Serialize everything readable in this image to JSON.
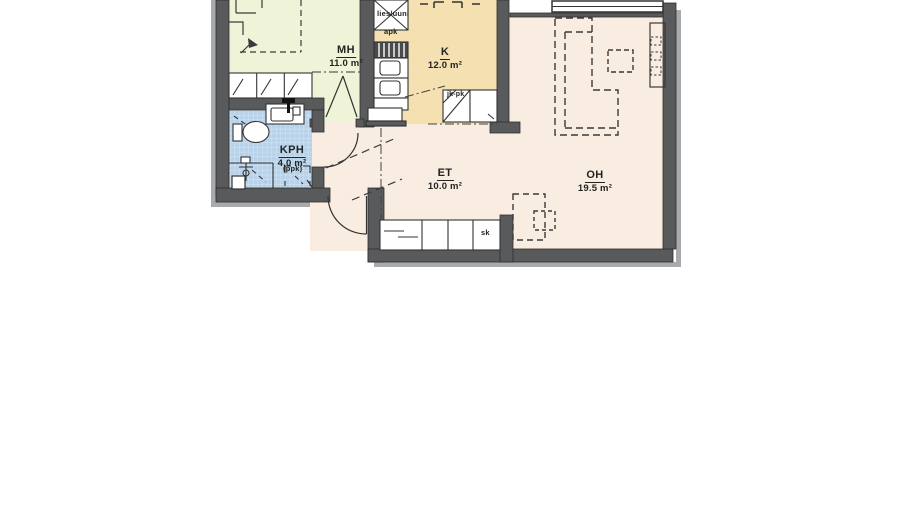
{
  "plan_title": "Apartment floor plan",
  "rooms": [
    {
      "id": "mh",
      "label": "MH",
      "area": "11.0 m²",
      "color": "#eff3d8"
    },
    {
      "id": "k",
      "label": "K",
      "area": "12.0 m²",
      "color": "#f5e0b2"
    },
    {
      "id": "kph",
      "label": "KPH",
      "area": "4.0 m²",
      "color": "#b7d2e9"
    },
    {
      "id": "et",
      "label": "ET",
      "area": "10.0 m²",
      "color": "#f9ede1"
    },
    {
      "id": "oh",
      "label": "OH",
      "area": "19.5 m²",
      "color": "#f9ede1"
    }
  ],
  "fixtures": {
    "stove_oven": "lies/uuni",
    "dishwasher": "apk",
    "fridge_freezer": "jk-pk",
    "washer_reservation": "(ppk)",
    "cleaning_closet": "sk"
  },
  "colors": {
    "wall": "#595a5c",
    "shadow": "#a8aaad",
    "line": "#333333"
  }
}
